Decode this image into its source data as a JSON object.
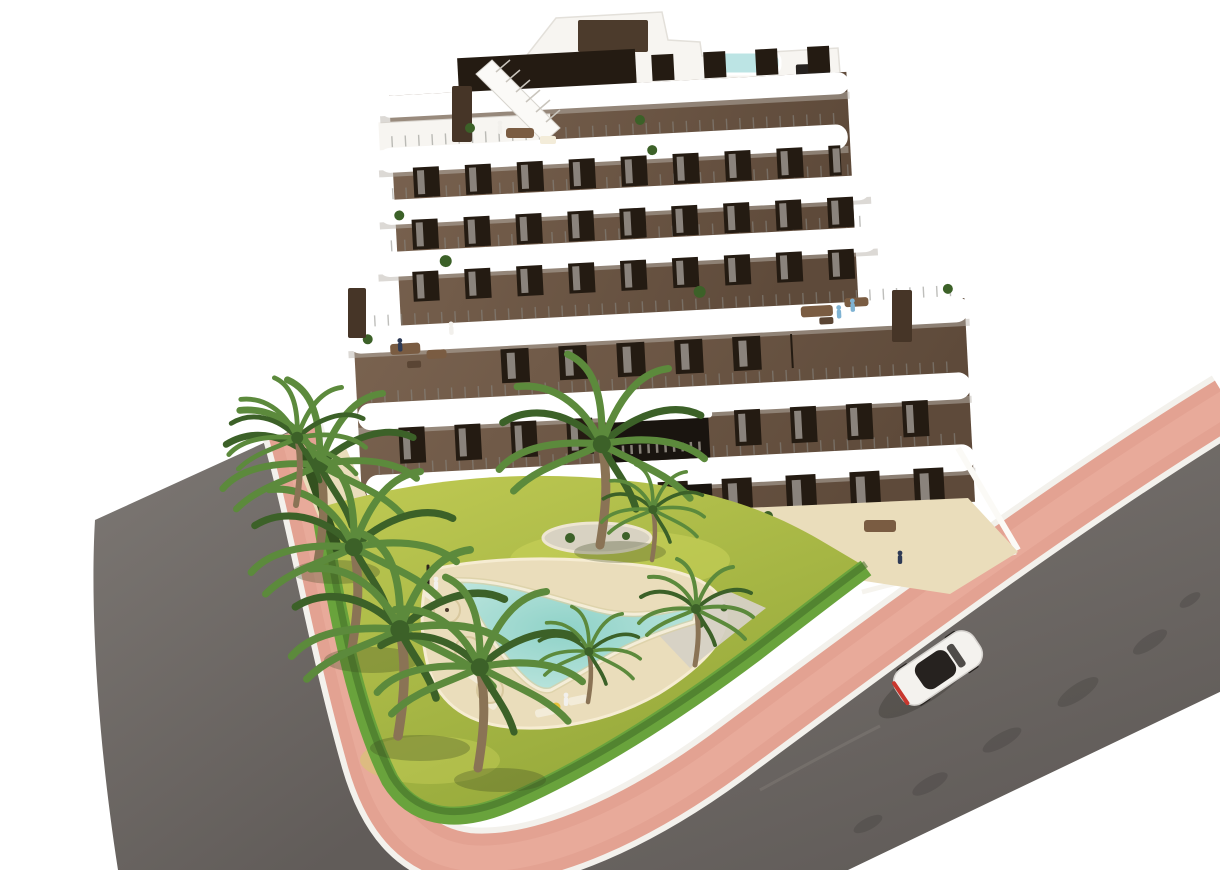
{
  "page": {
    "title": "New-build apartment complex — aerial 3D exterior render"
  },
  "scene": {
    "type": "architectural-3d-render",
    "description": "Aerial view of a modern seven-storey apartment building with dark brown facades and white curved wrap-around terraces, set on a corner plot with a landscaped garden, boomerang-shaped swimming pool, palm trees, salmon-pink pavements and asphalt streets; a white car drives on the right-hand road. Background is plain white.",
    "building": {
      "storeys": 7,
      "facade": "dark chocolate brown render",
      "balconies": "white rounded stacked terrace bands with glass railings",
      "features": [
        "rooftop plunge pool",
        "roof stair bulkhead",
        "white roof terrace",
        "two dark chimneys",
        "recessed dark entrance lobby",
        "penthouse lounge terraces with people",
        "ground-floor terraces with dining tables and sofas"
      ]
    },
    "garden": {
      "features": [
        "boomerang-shaped turquoise pool with sandy shallow edge",
        "beige pool deck",
        "sun loungers",
        "parasols",
        "central palm island bed",
        "gravel planting beds",
        "bright trimmed perimeter hedge",
        "yellow-green lawn",
        "travertine walkways"
      ],
      "palm_tree_count": 9,
      "sun_lounger_count": 7,
      "parasol_count": 3
    },
    "street": {
      "features": [
        "dark asphalt road wrapping the corner plot",
        "salmon pink sidewalk band with white curbs",
        "tar stains along far road edge"
      ],
      "car_count": 1,
      "car": "white sedan seen from above, nose pointing up-right, red taillights at rear"
    },
    "people_visible_approx": 12
  },
  "palette": {
    "bg": "#ffffff",
    "road_light": "#7d7874",
    "road_dark": "#615c59",
    "road_stain": "#3e3b39",
    "sidewalk": "#e3a292",
    "sidewalk_light": "#eeb4a3",
    "curb": "#f3f1ec",
    "hedge": "#69a33c",
    "hedge_dark": "#3f6b27",
    "lawn_light": "#bcc751",
    "lawn_dark": "#8fa437",
    "deck": "#ead dbb",
    "island": "#d8d2c2",
    "gravel": "#d6d1c5",
    "pool_edge_sand": "#d8cfa4",
    "pool_shallow": "#c6e9e2",
    "pool_deep": "#8fd2c8",
    "coping": "#f4edd8",
    "facade_light": "#7a6350",
    "facade_dark": "#5e4a3a",
    "window": "#241b12",
    "curtain": "#efece6",
    "band": "#ffffff",
    "band_shadow": "#b9b4ac",
    "railing": "#8a8a85",
    "roof": "#f7f5f1",
    "bulkhead": "#4c3b2c",
    "chimney": "#463527",
    "rooftop_pool": "#bce4e4",
    "stair": "#fbfaf7",
    "trunk": "#8a7355",
    "palm": "#5c8a3c",
    "palm_dark": "#3c6128",
    "furniture_wood": "#7a5c42",
    "table_white": "#f3ecd9",
    "wall": "#fbfaf6",
    "entrance": "#19140f",
    "car_body": "#f4f2ee",
    "car_glass": "#26221f",
    "car_tail": "#c8372e",
    "person_navy": "#2e3a55",
    "person_white": "#f2f0ec",
    "person_blue": "#7fb3d3",
    "person_yellow": "#e8c23a",
    "shade": "#3a4a22",
    "deck_fix": "#eaddbb"
  }
}
